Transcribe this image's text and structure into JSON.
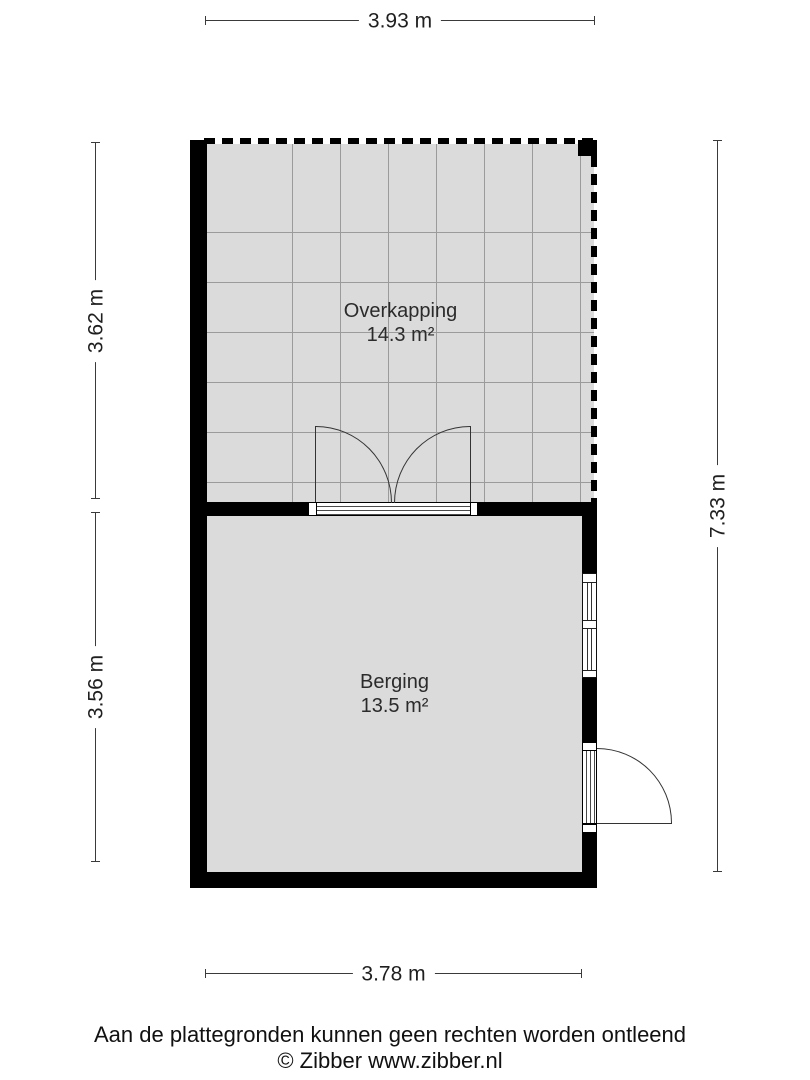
{
  "title": "Floor plan",
  "colors": {
    "wall": "#000000",
    "floor": "#dbdbdb",
    "grid_line": "#9b9b9b",
    "dimension_line": "#3a3a3a",
    "background": "#ffffff"
  },
  "rooms": [
    {
      "name": "Overkapping",
      "area": "14.3 m²"
    },
    {
      "name": "Berging",
      "area": "13.5 m²"
    }
  ],
  "dimensions": {
    "top": "3.93 m",
    "left_upper": "3.62 m",
    "left_lower": "3.56 m",
    "right": "7.33 m",
    "bottom": "3.78 m"
  },
  "footer": {
    "disclaimer": "Aan de plattegronden kunnen geen rechten worden ontleend",
    "credit": "© Zibber www.zibber.nl"
  }
}
